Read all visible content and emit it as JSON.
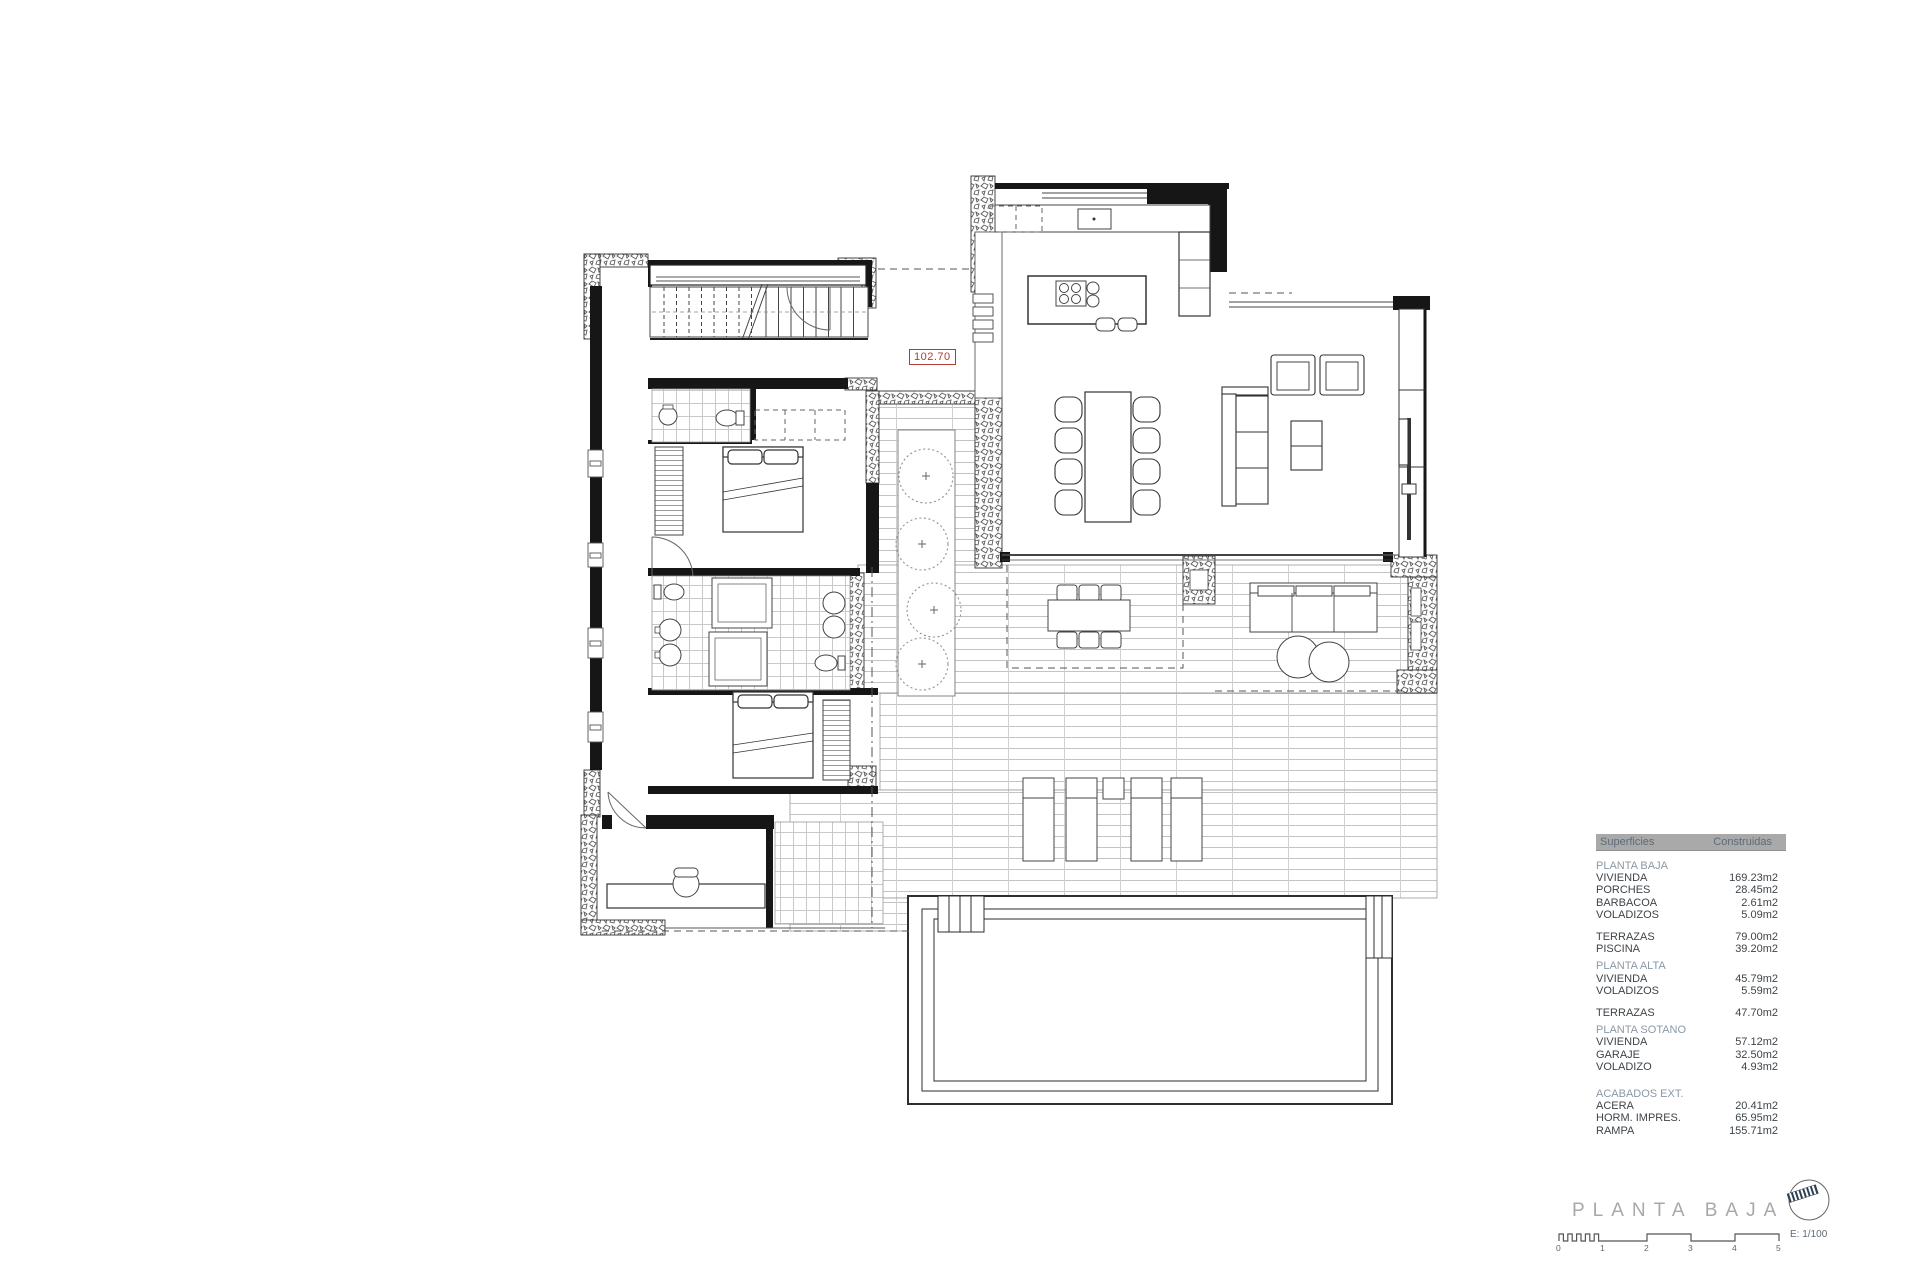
{
  "plan": {
    "level_label": "102.70"
  },
  "areas_table": {
    "header": {
      "col1": "Superficies",
      "col2": "Construidas"
    },
    "rows": [
      {
        "type": "section",
        "label": "PLANTA BAJA"
      },
      {
        "type": "item",
        "label": "VIVIENDA",
        "value": "169.23m2"
      },
      {
        "type": "item",
        "label": "PORCHES",
        "value": "28.45m2"
      },
      {
        "type": "item",
        "label": "BARBACOA",
        "value": "2.61m2"
      },
      {
        "type": "item",
        "label": "VOLADIZOS",
        "value": "5.09m2"
      },
      {
        "type": "gap"
      },
      {
        "type": "item",
        "label": "TERRAZAS",
        "value": "79.00m2"
      },
      {
        "type": "item",
        "label": "PISCINA",
        "value": "39.20m2"
      },
      {
        "type": "section",
        "label": "PLANTA ALTA"
      },
      {
        "type": "item",
        "label": "VIVIENDA",
        "value": "45.79m2"
      },
      {
        "type": "item",
        "label": "VOLADIZOS",
        "value": "5.59m2"
      },
      {
        "type": "gap"
      },
      {
        "type": "item",
        "label": "TERRAZAS",
        "value": "47.70m2"
      },
      {
        "type": "section",
        "label": "PLANTA SOTANO"
      },
      {
        "type": "item",
        "label": "VIVIENDA",
        "value": "57.12m2"
      },
      {
        "type": "item",
        "label": "GARAJE",
        "value": "32.50m2"
      },
      {
        "type": "item",
        "label": "VOLADIZO",
        "value": "4.93m2"
      },
      {
        "type": "gap"
      },
      {
        "type": "section",
        "label": "ACABADOS EXT."
      },
      {
        "type": "item",
        "label": "ACERA",
        "value": "20.41m2"
      },
      {
        "type": "item",
        "label": "HORM. IMPRES.",
        "value": "65.95m2"
      },
      {
        "type": "item",
        "label": "RAMPA",
        "value": "155.71m2"
      }
    ]
  },
  "title_block": {
    "title": "PLANTA BAJA",
    "scale_text": "E: 1/100",
    "scale_ticks": [
      "0",
      "1",
      "2",
      "3",
      "4",
      "5"
    ]
  },
  "colors": {
    "accent_red": "#b23b32",
    "table_header_bg": "#a9a9a9",
    "table_header_text": "#5c6b78",
    "section_text": "#8b99a6",
    "body_text": "#3e4449",
    "title_text": "#a8a8a8",
    "logo_stripe": "#2e4054"
  }
}
